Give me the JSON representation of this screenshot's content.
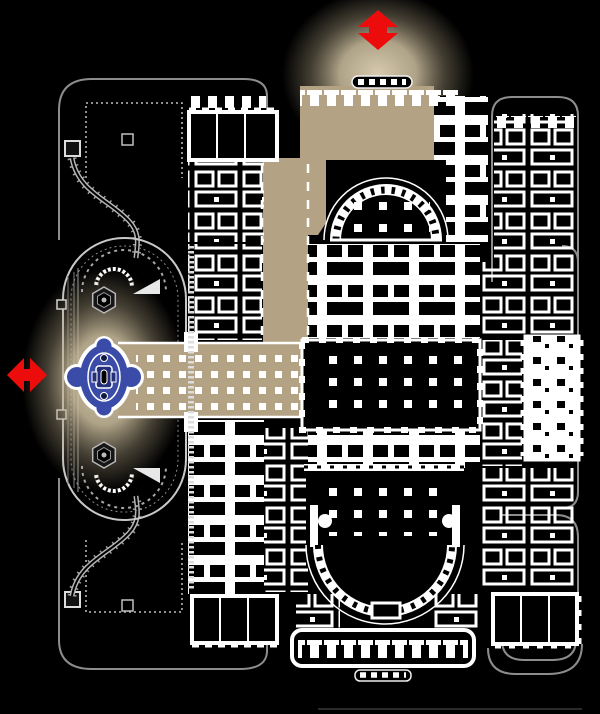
{
  "map": {
    "type": "building-floor-plan",
    "background": "#000000",
    "colors": {
      "plan_white": "#ffffff",
      "path_gray": "#8d8d8d",
      "path_light": "#c8c8c8",
      "route_tan": "#b3a284",
      "glow_tan": "#dccfb2",
      "arrow_red": "#ed0c0c",
      "fountain_blue": "#3b4ba8",
      "fountain_navy": "#233079",
      "room_black": "#000000"
    },
    "arrows": [
      {
        "id": "north",
        "orientation": "vertical",
        "style": "double-headed"
      },
      {
        "id": "west",
        "orientation": "horizontal",
        "style": "double-headed"
      }
    ],
    "route_segments": [
      "west-fountain-plaza",
      "west-colonnade-hall",
      "central-corridor",
      "north-entrance-hall"
    ],
    "landmarks": [
      "oval-terrace",
      "fountain",
      "hex-planter-north",
      "hex-planter-south",
      "north-semicircular-chamber",
      "south-semicircular-chamber",
      "crypt-column-grid",
      "north-portico",
      "south-portico",
      "northwest-garden-path",
      "southwest-garden-path",
      "northeast-court-path",
      "southeast-court-path"
    ]
  }
}
